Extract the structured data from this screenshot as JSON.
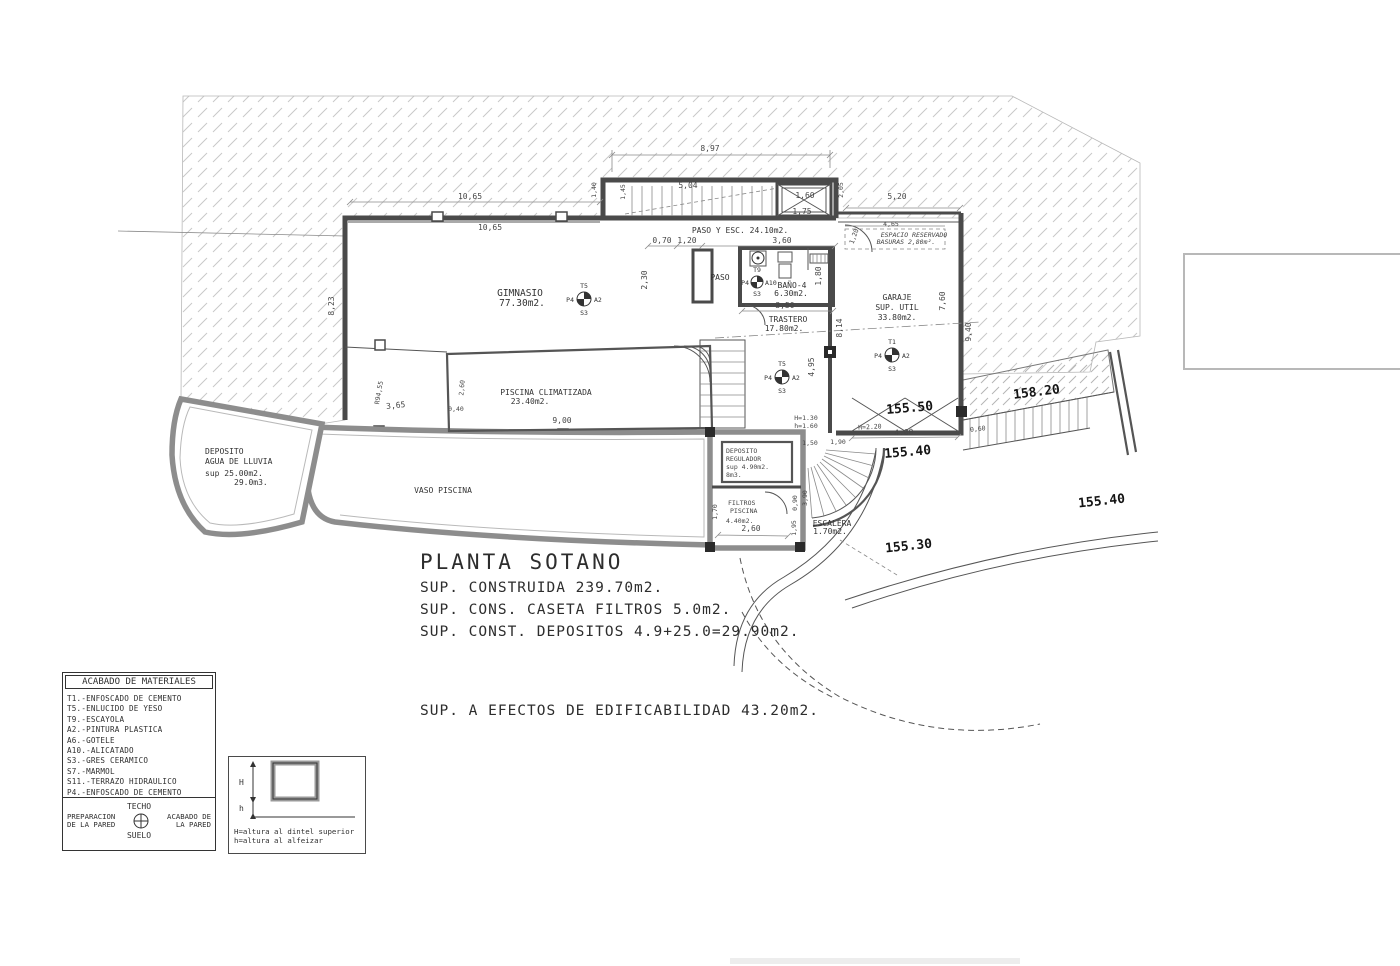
{
  "drawing": {
    "title": "PLANTA SOTANO",
    "sup_lines": {
      "l1": "SUP. CONSTRUIDA 239.70m2.",
      "l2": "SUP. CONS. CASETA FILTROS 5.0m2.",
      "l3": "SUP. CONST. DEPOSITOS 4.9+25.0=29.90m2.",
      "edificabilidad": "SUP. A EFECTOS DE EDIFICABILIDAD 43.20m2."
    }
  },
  "rooms": {
    "gimnasio": {
      "name": "GIMNASIO",
      "area": "77.30m2."
    },
    "paso_esc": {
      "name": "PASO Y ESC. 24.10m2."
    },
    "paso": {
      "name": "PASO"
    },
    "bano4": {
      "name": "BAÑO-4",
      "area": "6.30m2."
    },
    "trastero": {
      "name": "TRASTERO",
      "area": "17.80m2."
    },
    "garaje": {
      "name": "GARAJE",
      "l2": "SUP. UTIL",
      "area": "33.80m2."
    },
    "piscina": {
      "name": "PISCINA CLIMATIZADA",
      "area": "23.40m2."
    },
    "vaso": {
      "name": "VASO PISCINA"
    },
    "dep_lluvia": {
      "l1": "DEPOSITO",
      "l2": "AGUA DE LLUVIA",
      "l3": "sup 25.00m2.",
      "l4": "29.0m3."
    },
    "dep_regulador": {
      "l1": "DEPOSITO",
      "l2": "REGULADOR",
      "l3": "sup 4.90m2.",
      "l4": "8m3."
    },
    "filtros": {
      "l1": "FILTROS",
      "l2": "PISCINA",
      "l3": "4.40m2."
    },
    "escalera": {
      "name": "ESCALERA",
      "area": "1.70m2."
    },
    "basuras": {
      "l1": "ESPACIO RESERVADO",
      "l2": "BASURAS 2,80m²."
    }
  },
  "levels": {
    "l5550": "155.50",
    "l5540a": "155.40",
    "l5820": "158.20",
    "l5540b": "155.40",
    "l5530": "155.30"
  },
  "heights": {
    "h130": "H=1.30",
    "h160": "h=1.60",
    "h220": "H=2.20"
  },
  "markers": {
    "gimnasio": {
      "top": "T5",
      "left": "P4",
      "right": "A2",
      "bottom": "S3"
    },
    "paso": {
      "top": "T9",
      "left": "P4",
      "right": "A10",
      "bottom": "S3"
    },
    "trastero": {
      "top": "T5",
      "left": "P4",
      "right": "A2",
      "bottom": "S3"
    },
    "garaje": {
      "top": "T1",
      "left": "P4",
      "right": "A2",
      "bottom": "S3"
    }
  },
  "dims": {
    "d_897": "8,97",
    "d_1065a": "10,65",
    "d_1065b": "10,65",
    "d_140": "1,40",
    "d_145": "1,45",
    "d_504": "5,04",
    "d_160": "1,60",
    "d_175": "1,75",
    "d_205": "2,05",
    "d_520": "5,20",
    "d_465": "4,65",
    "d_070": "0,70",
    "d_120a": "1,20",
    "d_360": "3,60",
    "d_230": "2,30",
    "d_180": "1,80",
    "d_350": "3,50",
    "d_120b": "1,20",
    "d_814": "8,14",
    "d_495": "4,95",
    "d_760": "7,60",
    "d_940": "9,40",
    "d_823": "8,23",
    "d_r9455": "R94,55",
    "d_365": "3,65",
    "d_260a": "2,60",
    "d_040": "0,40",
    "d_900": "9,00",
    "d_400": "4.00",
    "d_150": "1,50",
    "d_190": "1,90",
    "d_090": "0,90",
    "d_390": "3,90",
    "d_195": "1,95",
    "d_260b": "2,60",
    "d_170": "1,70",
    "d_060": "0,60"
  },
  "materials_legend": {
    "header": "ACABADO DE MATERIALES",
    "items": [
      "T1.-ENFOSCADO DE CEMENTO",
      "T5.-ENLUCIDO DE YESO",
      "T9.-ESCAYOLA",
      "A2.-PINTURA PLASTICA",
      "A6.-GOTELE",
      "A10.-ALICATADO",
      "S3.-GRES CERAMICO",
      "S7.-MARMOL",
      "S11.-TERRAZO HIDRAULICO",
      "P4.-ENFOSCADO DE CEMENTO",
      "P8.-ENLUCIDO DE YESO"
    ],
    "techo": "TECHO",
    "prep_l1": "PREPARACION",
    "prep_l2": "DE LA PARED",
    "acab_l1": "ACABADO DE",
    "acab_l2": "LA PARED",
    "suelo": "SUELO"
  },
  "window_legend": {
    "H": "H",
    "h": "h",
    "line1": "H=altura al dintel superior",
    "line2": "h=altura al alfeizar"
  },
  "colors": {
    "wall": "#4a4a4a",
    "pool_wall": "#8d8d8d",
    "hatch": "#c8c8c8",
    "text": "#3d3d3d",
    "level_text": "#141414"
  }
}
